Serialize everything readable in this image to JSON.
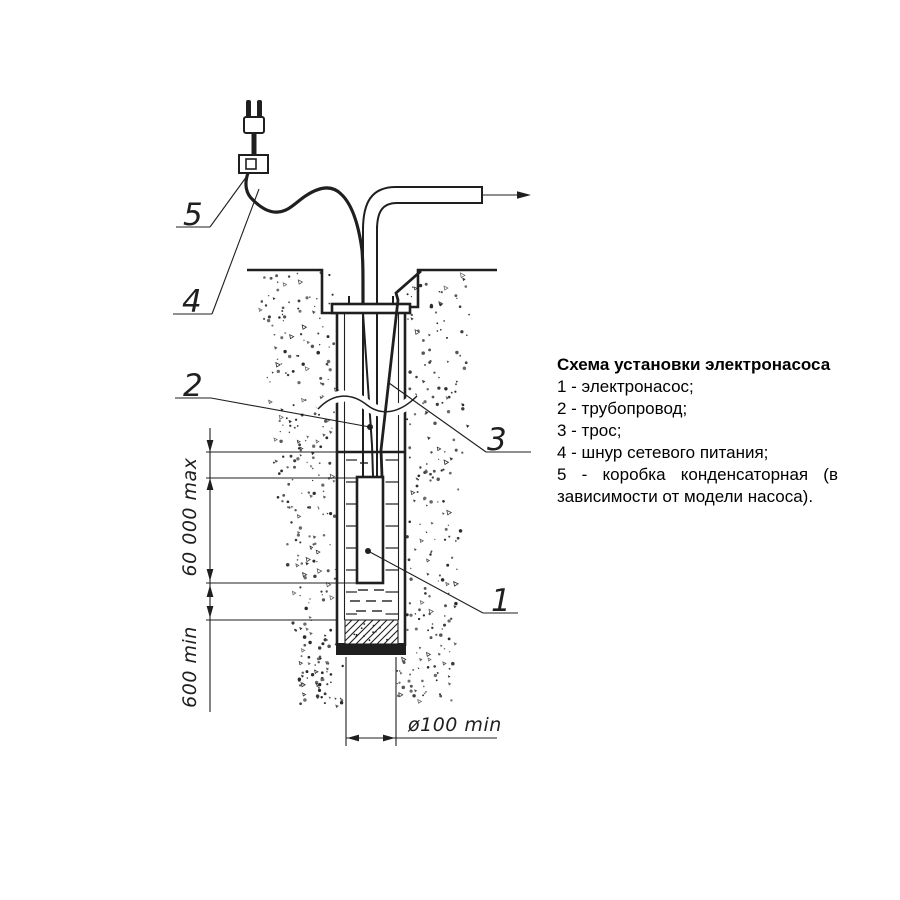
{
  "legend": {
    "title": "Схема установки электронасоса",
    "items": [
      "1 - электронасос;",
      "2 - трубопровод;",
      "3 - трос;",
      "4 - шнур сетевого питания;"
    ],
    "item5_line1": "5 - коробка конденсаторная (в",
    "item5_line2": "зависимости от модели насоса)."
  },
  "callouts": {
    "pump": "1",
    "pipe": "2",
    "rope": "3",
    "cord": "4",
    "box": "5"
  },
  "dimensions": {
    "immersion_max": "60 000 max",
    "bottom_clearance_min": "600 min",
    "bore_diameter_min": "ø100 min"
  },
  "colors": {
    "ink": "#1f1f1f",
    "background": "#ffffff"
  }
}
